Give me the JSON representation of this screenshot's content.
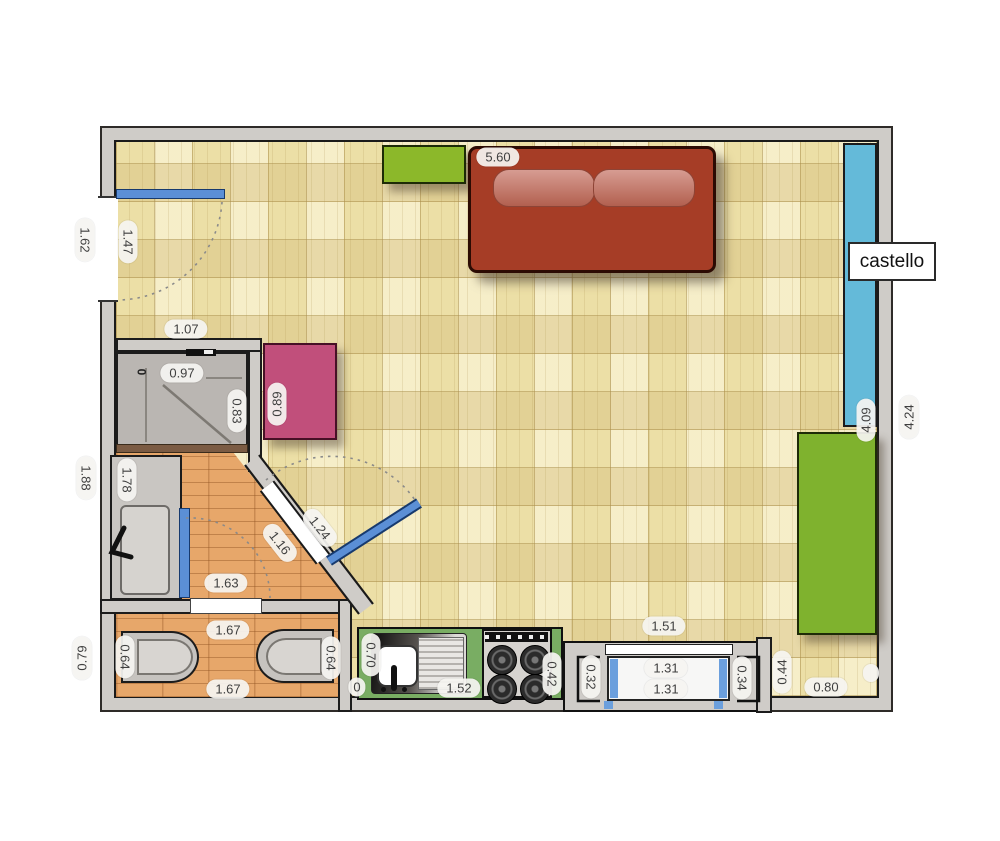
{
  "labels": {
    "castello": "castello"
  },
  "colors": {
    "wall_gray": "#cfccc8",
    "parquet": "#ecdfa6",
    "wood_floor": "#e7a76a",
    "loft_bed_blue": "#64bad9",
    "door_blue": "#5b8fd6",
    "window_blue": "#6b9fdd",
    "sofa_red": "#a63d26",
    "furniture_green": "#8cb82a",
    "wardrobe_green": "#7fb22e",
    "counter_green": "#79ad63",
    "pink_table": "#c14f7b"
  },
  "dims": [
    {
      "name": "sofa-wall-width",
      "value": "5.60"
    },
    {
      "name": "entry-opening-outer",
      "value": "1.62"
    },
    {
      "name": "entry-opening-inner",
      "value": "1.47"
    },
    {
      "name": "bath-top-wall",
      "value": "1.07"
    },
    {
      "name": "shower-width",
      "value": "0.97"
    },
    {
      "name": "shower-depth",
      "value": "0.83"
    },
    {
      "name": "pink-table-depth",
      "value": "0.89"
    },
    {
      "name": "bath-outer-height",
      "value": "1.88"
    },
    {
      "name": "bath-inner-height",
      "value": "1.78"
    },
    {
      "name": "diagonal-door-outer",
      "value": "1.24"
    },
    {
      "name": "diagonal-door-inner",
      "value": "1.16"
    },
    {
      "name": "bath-floor-width",
      "value": "1.63"
    },
    {
      "name": "wc-outer-depth",
      "value": "0.79"
    },
    {
      "name": "wc-width-top",
      "value": "1.67"
    },
    {
      "name": "bidet-length",
      "value": "0.64"
    },
    {
      "name": "toilet-length",
      "value": "0.64"
    },
    {
      "name": "wc-width-bottom",
      "value": "1.67"
    },
    {
      "name": "kitchen-sink-depth",
      "value": "0.70"
    },
    {
      "name": "kitchen-width",
      "value": "1.52"
    },
    {
      "name": "stove-width",
      "value": "0.42"
    },
    {
      "name": "window-return-left",
      "value": "0.32"
    },
    {
      "name": "window-width-a",
      "value": "1.31"
    },
    {
      "name": "window-width-b",
      "value": "1.31"
    },
    {
      "name": "window-return-right",
      "value": "0.34"
    },
    {
      "name": "recess-depth",
      "value": "0.44"
    },
    {
      "name": "window-bay-width",
      "value": "1.51"
    },
    {
      "name": "floor-right-width",
      "value": "0.80"
    },
    {
      "name": "right-wall-inner",
      "value": "4.09"
    },
    {
      "name": "right-wall-outer",
      "value": "4.24"
    },
    {
      "name": "shower-zero-mark",
      "value": "0"
    },
    {
      "name": "clipped-label",
      "value": "0"
    }
  ]
}
